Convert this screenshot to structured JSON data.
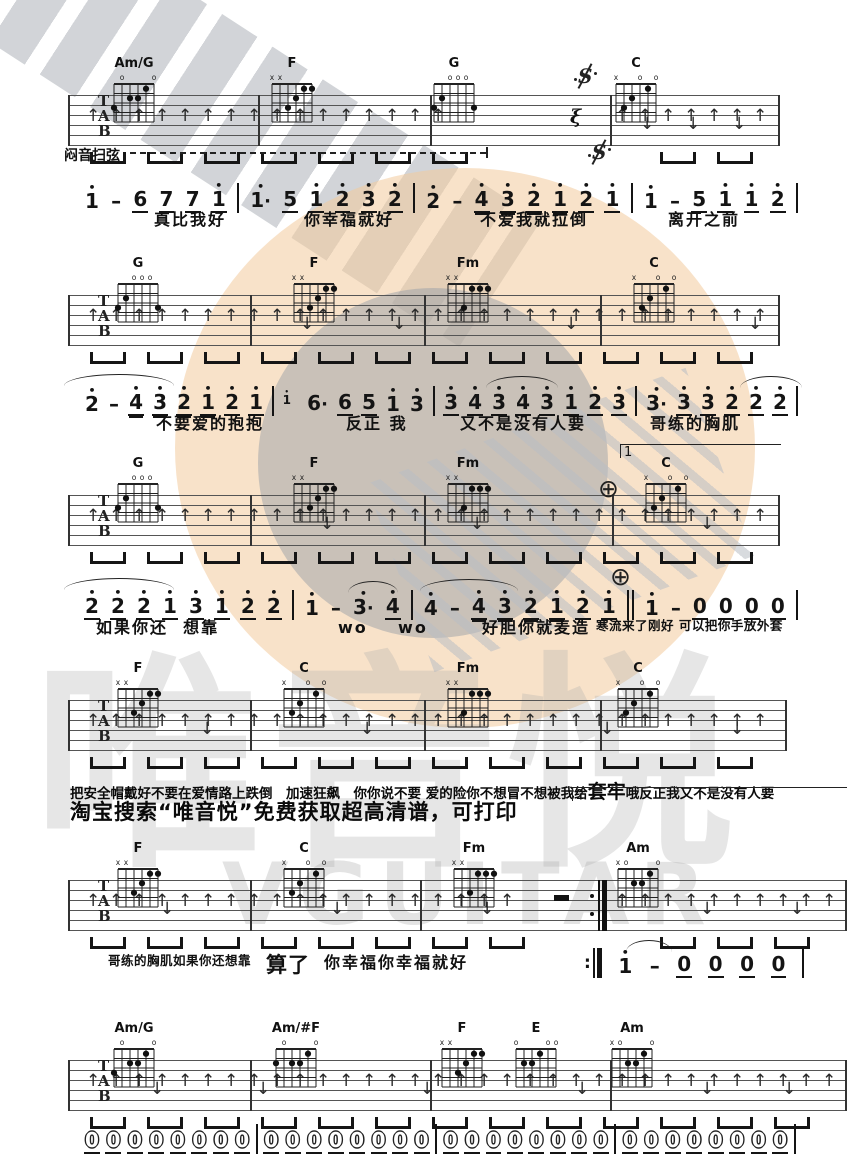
{
  "watermark": {
    "brand_text": "唯音悦",
    "brand_sub": "VGUITAR"
  },
  "texts": {
    "mute_strum": "闷音扫弦",
    "promo": "淘宝搜索“唯音悦”免费获取超高清谱，可打印",
    "line4_segments": [
      {
        "t": "把安全帽戴好不要在爱情路上跌倒"
      },
      {
        "t": "　加速狂飙　"
      },
      {
        "t": "你你说不要 爱的险你不想冒不想被我给"
      },
      {
        "t": "套牢",
        "big": true
      },
      {
        "t": " 哦反正我又不是没有人要"
      }
    ]
  },
  "tab_letters": [
    "T",
    "A",
    "B"
  ],
  "staff_default": {
    "x1": 68,
    "h": 51
  },
  "chord_shapes": {
    "Am/G": {
      "markers": [
        "",
        "o",
        "",
        "",
        "",
        "o"
      ],
      "dots": [
        [
          1,
          3
        ],
        [
          3,
          2
        ],
        [
          4,
          2
        ],
        [
          5,
          1
        ]
      ]
    },
    "F": {
      "markers": [
        "x",
        "x",
        "",
        "",
        "",
        ""
      ],
      "dots": [
        [
          3,
          3
        ],
        [
          4,
          2
        ],
        [
          5,
          1
        ],
        [
          6,
          1
        ]
      ]
    },
    "G": {
      "markers": [
        "",
        "",
        "o",
        "o",
        "o",
        ""
      ],
      "dots": [
        [
          1,
          3
        ],
        [
          2,
          2
        ],
        [
          6,
          3
        ]
      ]
    },
    "C": {
      "markers": [
        "x",
        "",
        "",
        "o",
        "",
        "o"
      ],
      "dots": [
        [
          2,
          3
        ],
        [
          3,
          2
        ],
        [
          5,
          1
        ]
      ]
    },
    "Fm": {
      "markers": [
        "x",
        "x",
        "",
        "",
        "",
        ""
      ],
      "dots": [
        [
          3,
          3
        ],
        [
          4,
          1
        ],
        [
          5,
          1
        ],
        [
          6,
          1
        ]
      ]
    },
    "Am": {
      "markers": [
        "x",
        "o",
        "",
        "",
        "",
        "o"
      ],
      "dots": [
        [
          3,
          2
        ],
        [
          4,
          2
        ],
        [
          5,
          1
        ]
      ]
    },
    "Am/#F": {
      "markers": [
        "",
        "o",
        "",
        "",
        "",
        "o"
      ],
      "dots": [
        [
          1,
          2
        ],
        [
          3,
          2
        ],
        [
          4,
          2
        ],
        [
          5,
          1
        ]
      ]
    },
    "E": {
      "markers": [
        "o",
        "",
        "",
        "",
        "o",
        "o"
      ],
      "dots": [
        [
          2,
          2
        ],
        [
          3,
          2
        ],
        [
          4,
          1
        ]
      ]
    }
  },
  "systems": [
    {
      "y": 95,
      "x2": 778,
      "chordY": 56,
      "chords": [
        {
          "label": "Am/G",
          "x": 106
        },
        {
          "label": "F",
          "x": 264
        },
        {
          "label": "G",
          "x": 426
        },
        {
          "label": "C",
          "x": 608
        }
      ],
      "bars": [
        68,
        258,
        430,
        610,
        778
      ],
      "arrows": {
        "gaps": [
          [
            445,
            606
          ]
        ],
        "downs": [
          640,
          686,
          732
        ]
      },
      "segnos": [
        {
          "x": 576,
          "y": 64
        },
        {
          "x": 590,
          "y": 140
        }
      ],
      "rest_q": {
        "x": 570,
        "y": 106
      }
    },
    {
      "y": 295,
      "x2": 778,
      "chordY": 256,
      "chords": [
        {
          "label": "G",
          "x": 110
        },
        {
          "label": "F",
          "x": 286
        },
        {
          "label": "Fm",
          "x": 440
        },
        {
          "label": "C",
          "x": 626
        }
      ],
      "bars": [
        68,
        250,
        424,
        600,
        778
      ],
      "arrows": {
        "downs": [
          300,
          392,
          564,
          748
        ]
      }
    },
    {
      "y": 495,
      "x2": 778,
      "chordY": 456,
      "chords": [
        {
          "label": "G",
          "x": 110
        },
        {
          "label": "F",
          "x": 286
        },
        {
          "label": "Fm",
          "x": 440
        },
        {
          "label": "C",
          "x": 638
        }
      ],
      "bars": [
        68,
        250,
        424,
        612,
        778
      ],
      "arrows": {
        "downs": [
          320,
          470,
          700
        ]
      },
      "codas": [
        {
          "x": 598,
          "y": 476
        },
        {
          "x": 610,
          "y": 564
        }
      ],
      "volta": {
        "x": 620,
        "w": 160,
        "y": 444,
        "label": "1"
      }
    },
    {
      "y": 700,
      "x2": 785,
      "chordY": 661,
      "chords": [
        {
          "label": "F",
          "x": 110
        },
        {
          "label": "C",
          "x": 276
        },
        {
          "label": "Fm",
          "x": 440
        },
        {
          "label": "C",
          "x": 610
        }
      ],
      "bars": [
        68,
        250,
        424,
        600,
        785
      ],
      "arrows": {
        "downs": [
          200,
          360,
          600,
          730
        ]
      }
    },
    {
      "y": 880,
      "x2": 845,
      "chordY": 841,
      "chords": [
        {
          "label": "F",
          "x": 110
        },
        {
          "label": "C",
          "x": 276
        },
        {
          "label": "Fm",
          "x": 446
        },
        {
          "label": "Am",
          "x": 610
        }
      ],
      "bars": [
        68,
        250,
        420,
        845
      ],
      "arrows": {
        "gaps": [
          [
            520,
            606
          ]
        ],
        "downs": [
          160,
          330,
          480,
          700,
          790
        ]
      },
      "repeat_end": {
        "x": 598
      },
      "rest_h": {
        "x": 554
      },
      "volta": {
        "x": 572,
        "w": 274,
        "y": 787,
        "label": "2"
      }
    },
    {
      "y": 1060,
      "x2": 845,
      "chordY": 1021,
      "chords": [
        {
          "label": "Am/G",
          "x": 106
        },
        {
          "label": "Am/#F",
          "x": 268
        },
        {
          "label": "F",
          "x": 434
        },
        {
          "label": "E",
          "x": 508
        },
        {
          "label": "Am",
          "x": 604
        }
      ],
      "bars": [
        68,
        250,
        430,
        610,
        845
      ],
      "arrows": {
        "downs": [
          150,
          256,
          420,
          575,
          700,
          782
        ]
      }
    }
  ],
  "notation_lines": [
    {
      "id": "line1",
      "y": 183,
      "x": 84,
      "w": 714,
      "tokens": [
        "1'",
        "–",
        "6_",
        "7_",
        "7_",
        "1'_",
        "|",
        "1'.",
        "5_",
        "1'_",
        "2'_",
        "3'_",
        "2'_",
        "|",
        "2'",
        "–",
        "4'=",
        "3'=",
        "2'=",
        "1'=",
        "2'_",
        "1'_",
        "|",
        "1'",
        "–",
        "5_",
        "1'_",
        "1'_",
        "2'_",
        "|"
      ],
      "lyrics_y": 212,
      "lyrics": [
        {
          "x": 154,
          "t": "真比我好"
        },
        {
          "x": 304,
          "t": "你幸福就好"
        },
        {
          "x": 480,
          "t": "不爱我就拉倒"
        },
        {
          "x": 668,
          "t": "离开之前"
        }
      ]
    },
    {
      "id": "line2",
      "y": 386,
      "x": 84,
      "w": 714,
      "tokens": [
        "2'",
        "–",
        "4'=",
        "3'=",
        "2'=",
        "1'=",
        "2'_",
        "1'_",
        "|",
        "~1'",
        "6.",
        "6_",
        "5_",
        "1'",
        "3'",
        "|",
        "3'_",
        "4'_",
        "3'_",
        "4'_",
        "3'_",
        "1'_",
        "2'_",
        "3'_",
        "|",
        "3'.",
        "3'_",
        "3'_",
        "2'_",
        "2'_",
        "2'_",
        "|"
      ],
      "lyrics_y": 416,
      "lyrics": [
        {
          "x": 156,
          "t": "不要爱的抱抱"
        },
        {
          "x": 346,
          "t": "反正 我"
        },
        {
          "x": 460,
          "t": "又不是没有人要"
        },
        {
          "x": 650,
          "t": "哥练的胸肌"
        }
      ],
      "arcs": [
        {
          "x": 64,
          "w": 110,
          "y": 374
        },
        {
          "x": 486,
          "w": 72,
          "y": 376
        },
        {
          "x": 740,
          "w": 62,
          "y": 376
        }
      ]
    },
    {
      "id": "line3",
      "y": 590,
      "x": 84,
      "w": 714,
      "tokens": [
        "2'_",
        "2'_",
        "2'_",
        "1'_",
        "3'_",
        "1'_",
        "2'_",
        "2'_",
        "|",
        "1'",
        "–",
        "3'.",
        "4'_",
        "|",
        "4'",
        "–",
        "4'=",
        "3'=",
        "2'=",
        "1'=",
        "2'_",
        "1'_",
        "||",
        "1'",
        "–",
        "0_",
        "0_",
        "0_",
        "0_",
        "|"
      ],
      "lyrics_y": 620,
      "lyrics": [
        {
          "x": 96,
          "t": "如果你还  想靠"
        },
        {
          "x": 338,
          "t": "wo    wo"
        },
        {
          "x": 482,
          "t": "好胆你就麦造"
        },
        {
          "x": 596,
          "t": "寒流来了刚好 可以把你手放外套",
          "small": true
        }
      ],
      "arcs": [
        {
          "x": 64,
          "w": 110,
          "y": 578
        },
        {
          "x": 348,
          "w": 50,
          "y": 581
        },
        {
          "x": 420,
          "w": 98,
          "y": 579
        }
      ]
    },
    {
      "id": "line5",
      "y": 948,
      "x": 584,
      "w": 220,
      "tokens": [
        ":||",
        "1'",
        "–",
        "0_",
        "0_",
        "0_",
        "0_",
        "|"
      ],
      "lyrics_y": 955,
      "lyrics": [
        {
          "x": 108,
          "t": "哥练的胸肌如果你还想靠",
          "small": true
        },
        {
          "x": 266,
          "t": "算了",
          "big": true
        },
        {
          "x": 324,
          "t": "你幸福你幸福就好"
        }
      ],
      "arcs": [
        {
          "x": 626,
          "w": 46,
          "y": 940
        }
      ]
    },
    {
      "id": "line6",
      "y": 1124,
      "x": 84,
      "w": 712,
      "outline": true,
      "tokens": [
        "0_",
        "0_",
        "0_",
        "0_",
        "0_",
        "0_",
        "0_",
        "0_",
        "|",
        "0_",
        "0_",
        "0_",
        "0_",
        "0_",
        "0_",
        "0_",
        "0_",
        "|",
        "0_",
        "0_",
        "0_",
        "0_",
        "0_",
        "0_",
        "0_",
        "0_",
        "|",
        "0_",
        "0_",
        "0_",
        "0_",
        "0_",
        "0_",
        "0_",
        "0_",
        "|"
      ]
    }
  ]
}
